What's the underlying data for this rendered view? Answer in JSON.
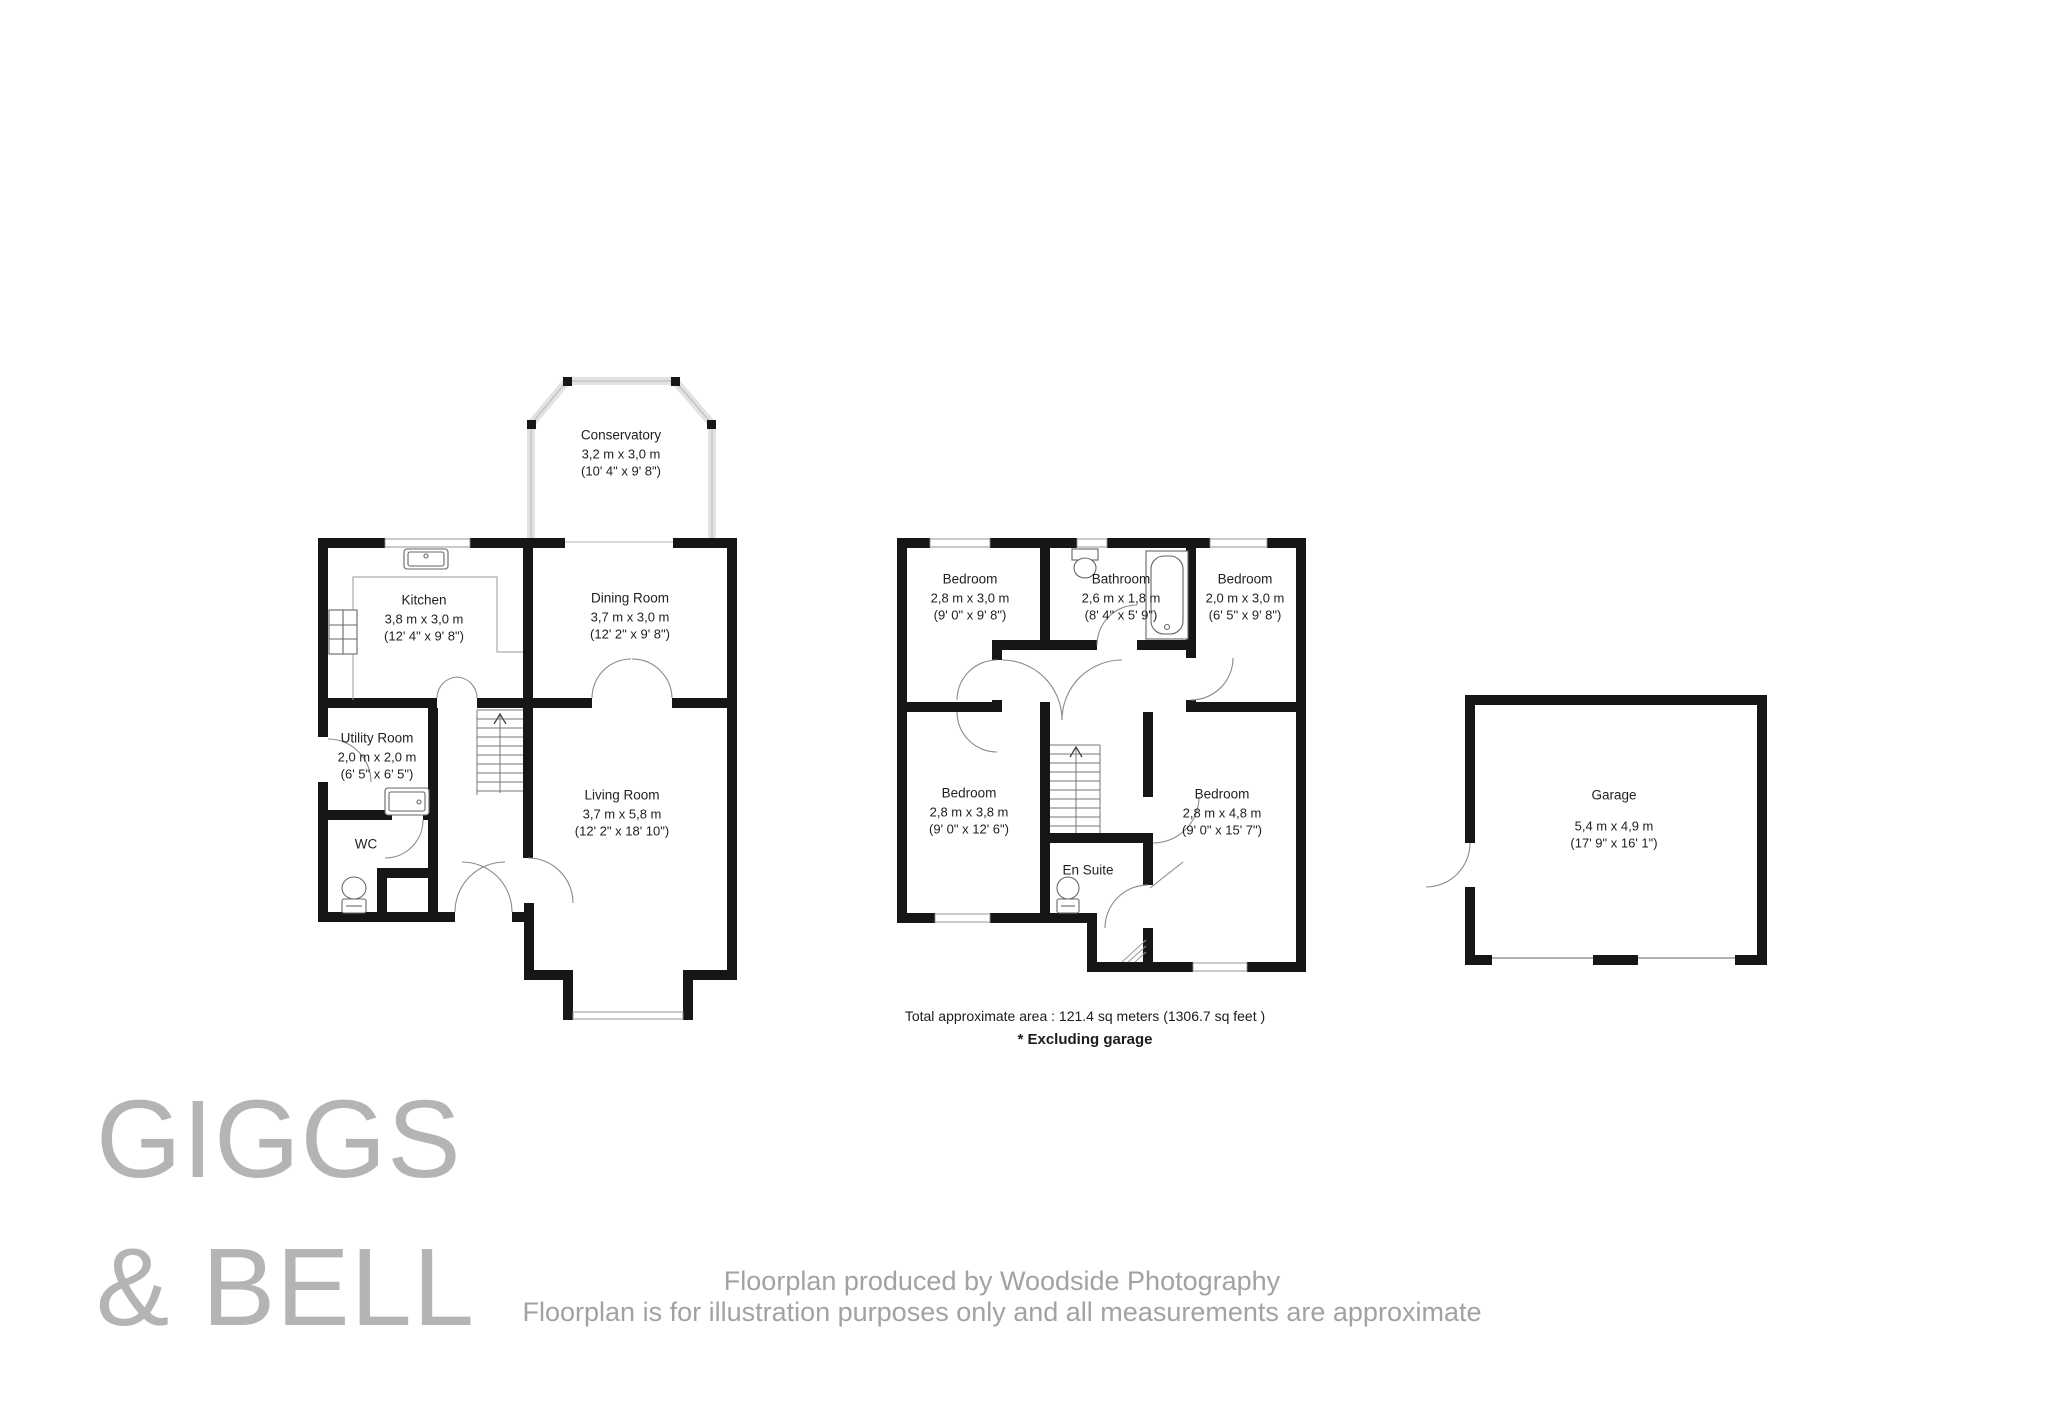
{
  "palette": {
    "wall": "#161616",
    "window_frame": "#8c8c8c",
    "conservatory_wall": "#e2e2e2",
    "door_arc": "#8a8a8a",
    "logo_gray": "#b2b4b6",
    "footer_gray": "#a2a2a2"
  },
  "floors": {
    "ground": {
      "rooms": {
        "conservatory": {
          "name": "Conservatory",
          "metric": "3,2 m x 3,0 m",
          "imperial": "(10' 4\" x 9' 8\")"
        },
        "kitchen": {
          "name": "Kitchen",
          "metric": "3,8 m x 3,0 m",
          "imperial": "(12' 4\" x 9' 8\")"
        },
        "dining": {
          "name": "Dining Room",
          "metric": "3,7 m x 3,0 m",
          "imperial": "(12' 2\" x 9' 8\")"
        },
        "utility": {
          "name": "Utility Room",
          "metric": "2,0 m x 2,0 m",
          "imperial": "(6' 5\" x 6' 5\")"
        },
        "wc": {
          "name": "WC"
        },
        "living": {
          "name": "Living Room",
          "metric": "3,7 m x 5,8 m",
          "imperial": "(12' 2\" x 18' 10\")"
        }
      }
    },
    "first": {
      "rooms": {
        "bedroom_front_left": {
          "name": "Bedroom",
          "metric": "2,8 m x 3,0 m",
          "imperial": "(9' 0\" x 9' 8\")"
        },
        "bathroom": {
          "name": "Bathroom",
          "metric": "2,6 m x 1,8 m",
          "imperial": "(8' 4\" x 5' 9\")"
        },
        "bedroom_front_right": {
          "name": "Bedroom",
          "metric": "2,0 m x 3,0 m",
          "imperial": "(6' 5\" x 9' 8\")"
        },
        "bedroom_back_left": {
          "name": "Bedroom",
          "metric": "2,8 m x 3,8 m",
          "imperial": "(9' 0\" x 12' 6\")"
        },
        "bedroom_back_right": {
          "name": "Bedroom",
          "metric": "2,8 m x 4,8 m",
          "imperial": "(9' 0\" x 15' 7\")"
        },
        "ensuite": {
          "name": "En Suite"
        }
      }
    },
    "garage": {
      "rooms": {
        "garage": {
          "name": "Garage",
          "metric": "5,4 m x 4,9 m",
          "imperial": "(17' 9\" x 16' 1\")"
        }
      }
    }
  },
  "summary": {
    "total_area": "Total approximate area : 121.4 sq meters (1306.7 sq feet )",
    "note": "* Excluding garage"
  },
  "branding": {
    "line1": "GIGGS",
    "line2": "& BELL"
  },
  "footer": {
    "line1": "Floorplan produced by Woodside Photography",
    "line2": "Floorplan is for illustration purposes only and all measurements are approximate"
  }
}
